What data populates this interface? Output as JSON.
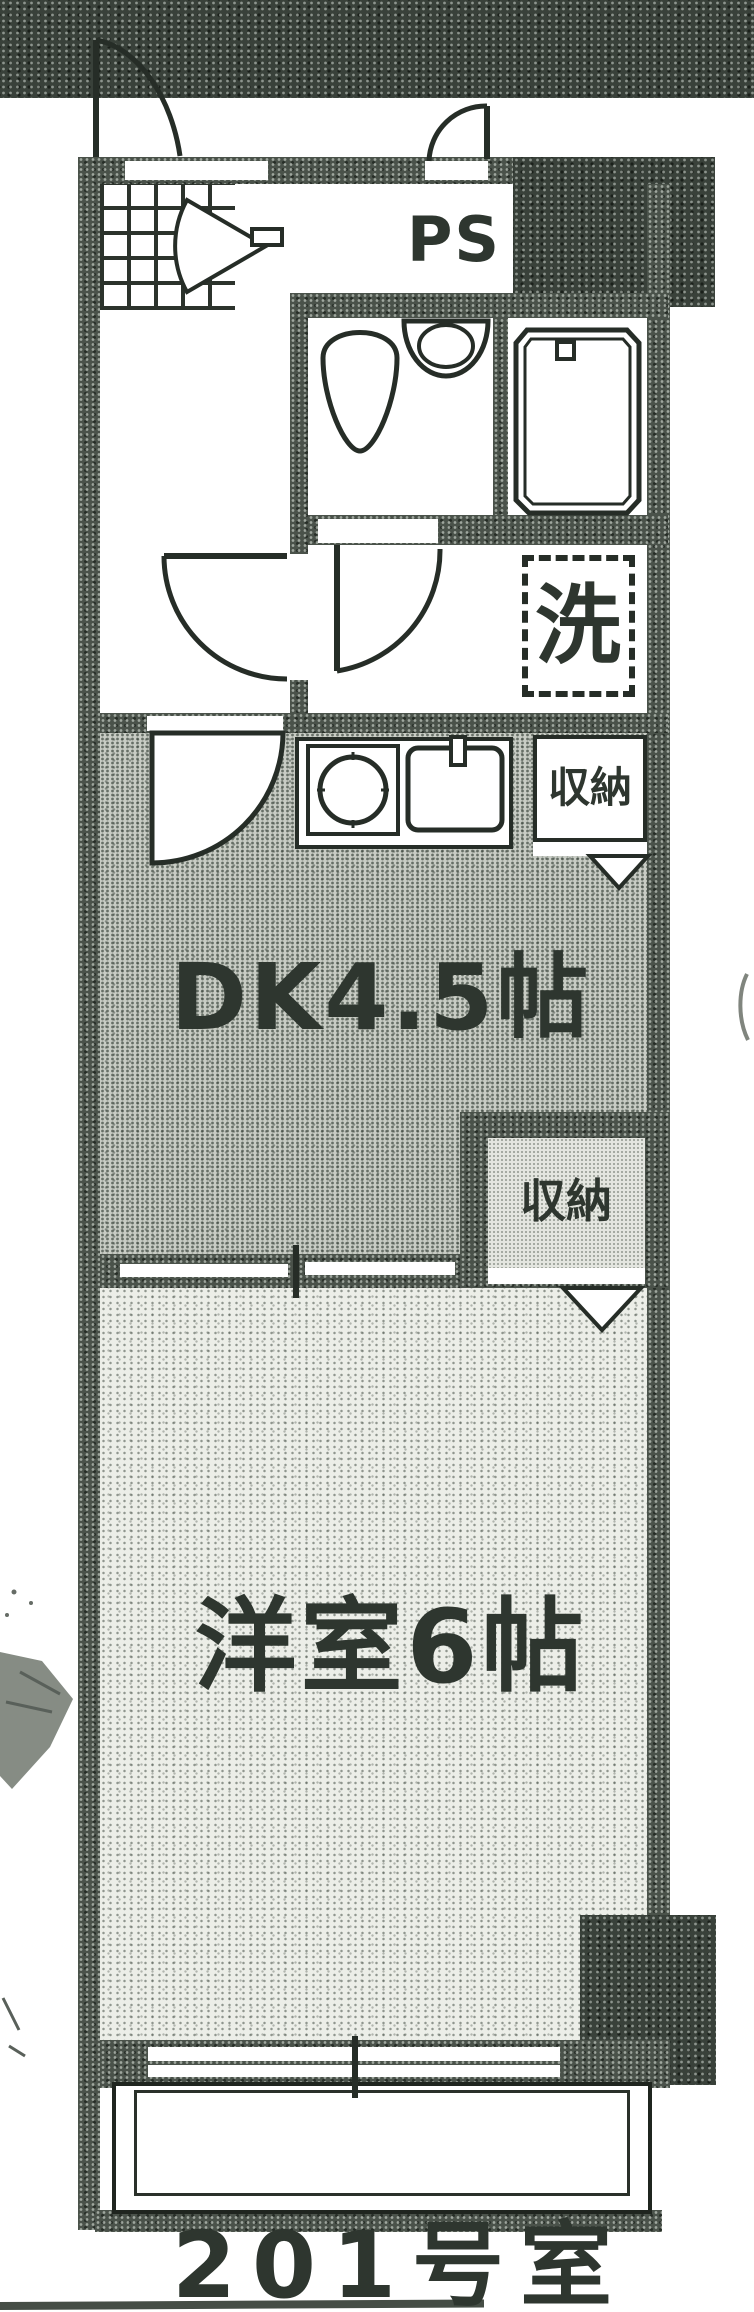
{
  "plan": {
    "room_number": "201号室",
    "labels": {
      "pipe_space": "PS",
      "washing_machine": "洗",
      "kitchen_storage": "収納",
      "dining_kitchen": "DK4.5帖",
      "bedroom_storage": "収納",
      "western_room": "洋室6帖"
    },
    "colors": {
      "ink": "#2c332c",
      "wall_fill": "#4a524a",
      "dk_floor": "#c8ccc4",
      "western_room_floor": "#eceee8"
    }
  }
}
